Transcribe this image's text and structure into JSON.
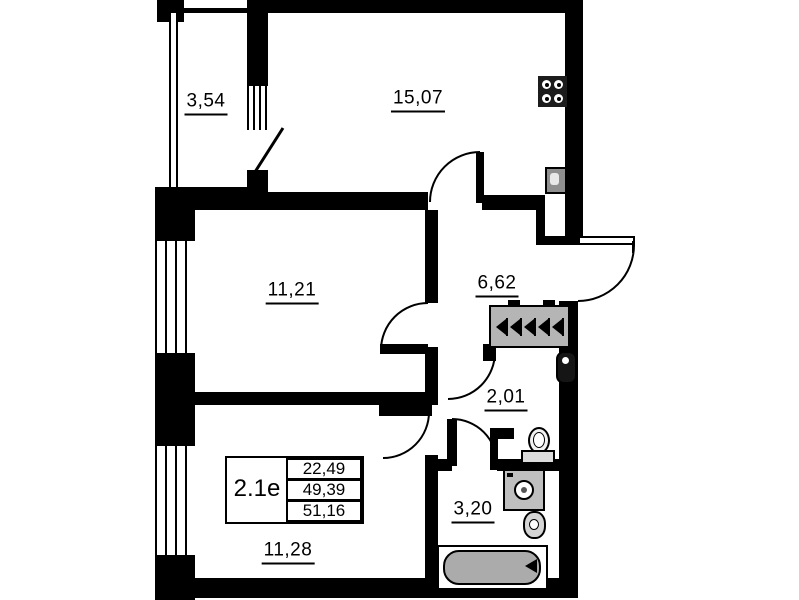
{
  "rooms": [
    {
      "name": "balcony",
      "area": "3,54"
    },
    {
      "name": "kitchen",
      "area": "15,07"
    },
    {
      "name": "living-room",
      "area": "11,21"
    },
    {
      "name": "hallway",
      "area": "6,62"
    },
    {
      "name": "wc",
      "area": "2,01"
    },
    {
      "name": "bathroom",
      "area": "3,20"
    },
    {
      "name": "bedroom",
      "area": "11,28"
    }
  ],
  "info_table": {
    "unit_type": "2.1е",
    "area_living": "22,49",
    "area_main": "49,39",
    "area_total": "51,16"
  },
  "fixtures": [
    "stove-icon",
    "kitchen-sink-icon",
    "water-heater-icon",
    "toilet-icon",
    "washing-machine-icon",
    "bath-sink-icon",
    "bathtub-icon",
    "wardrobe-hangers-icon"
  ],
  "colors": {
    "wall": "#000000",
    "background": "#ffffff",
    "fixture_fill": "#b5b5b5",
    "bathtub_fill": "#ababab"
  }
}
